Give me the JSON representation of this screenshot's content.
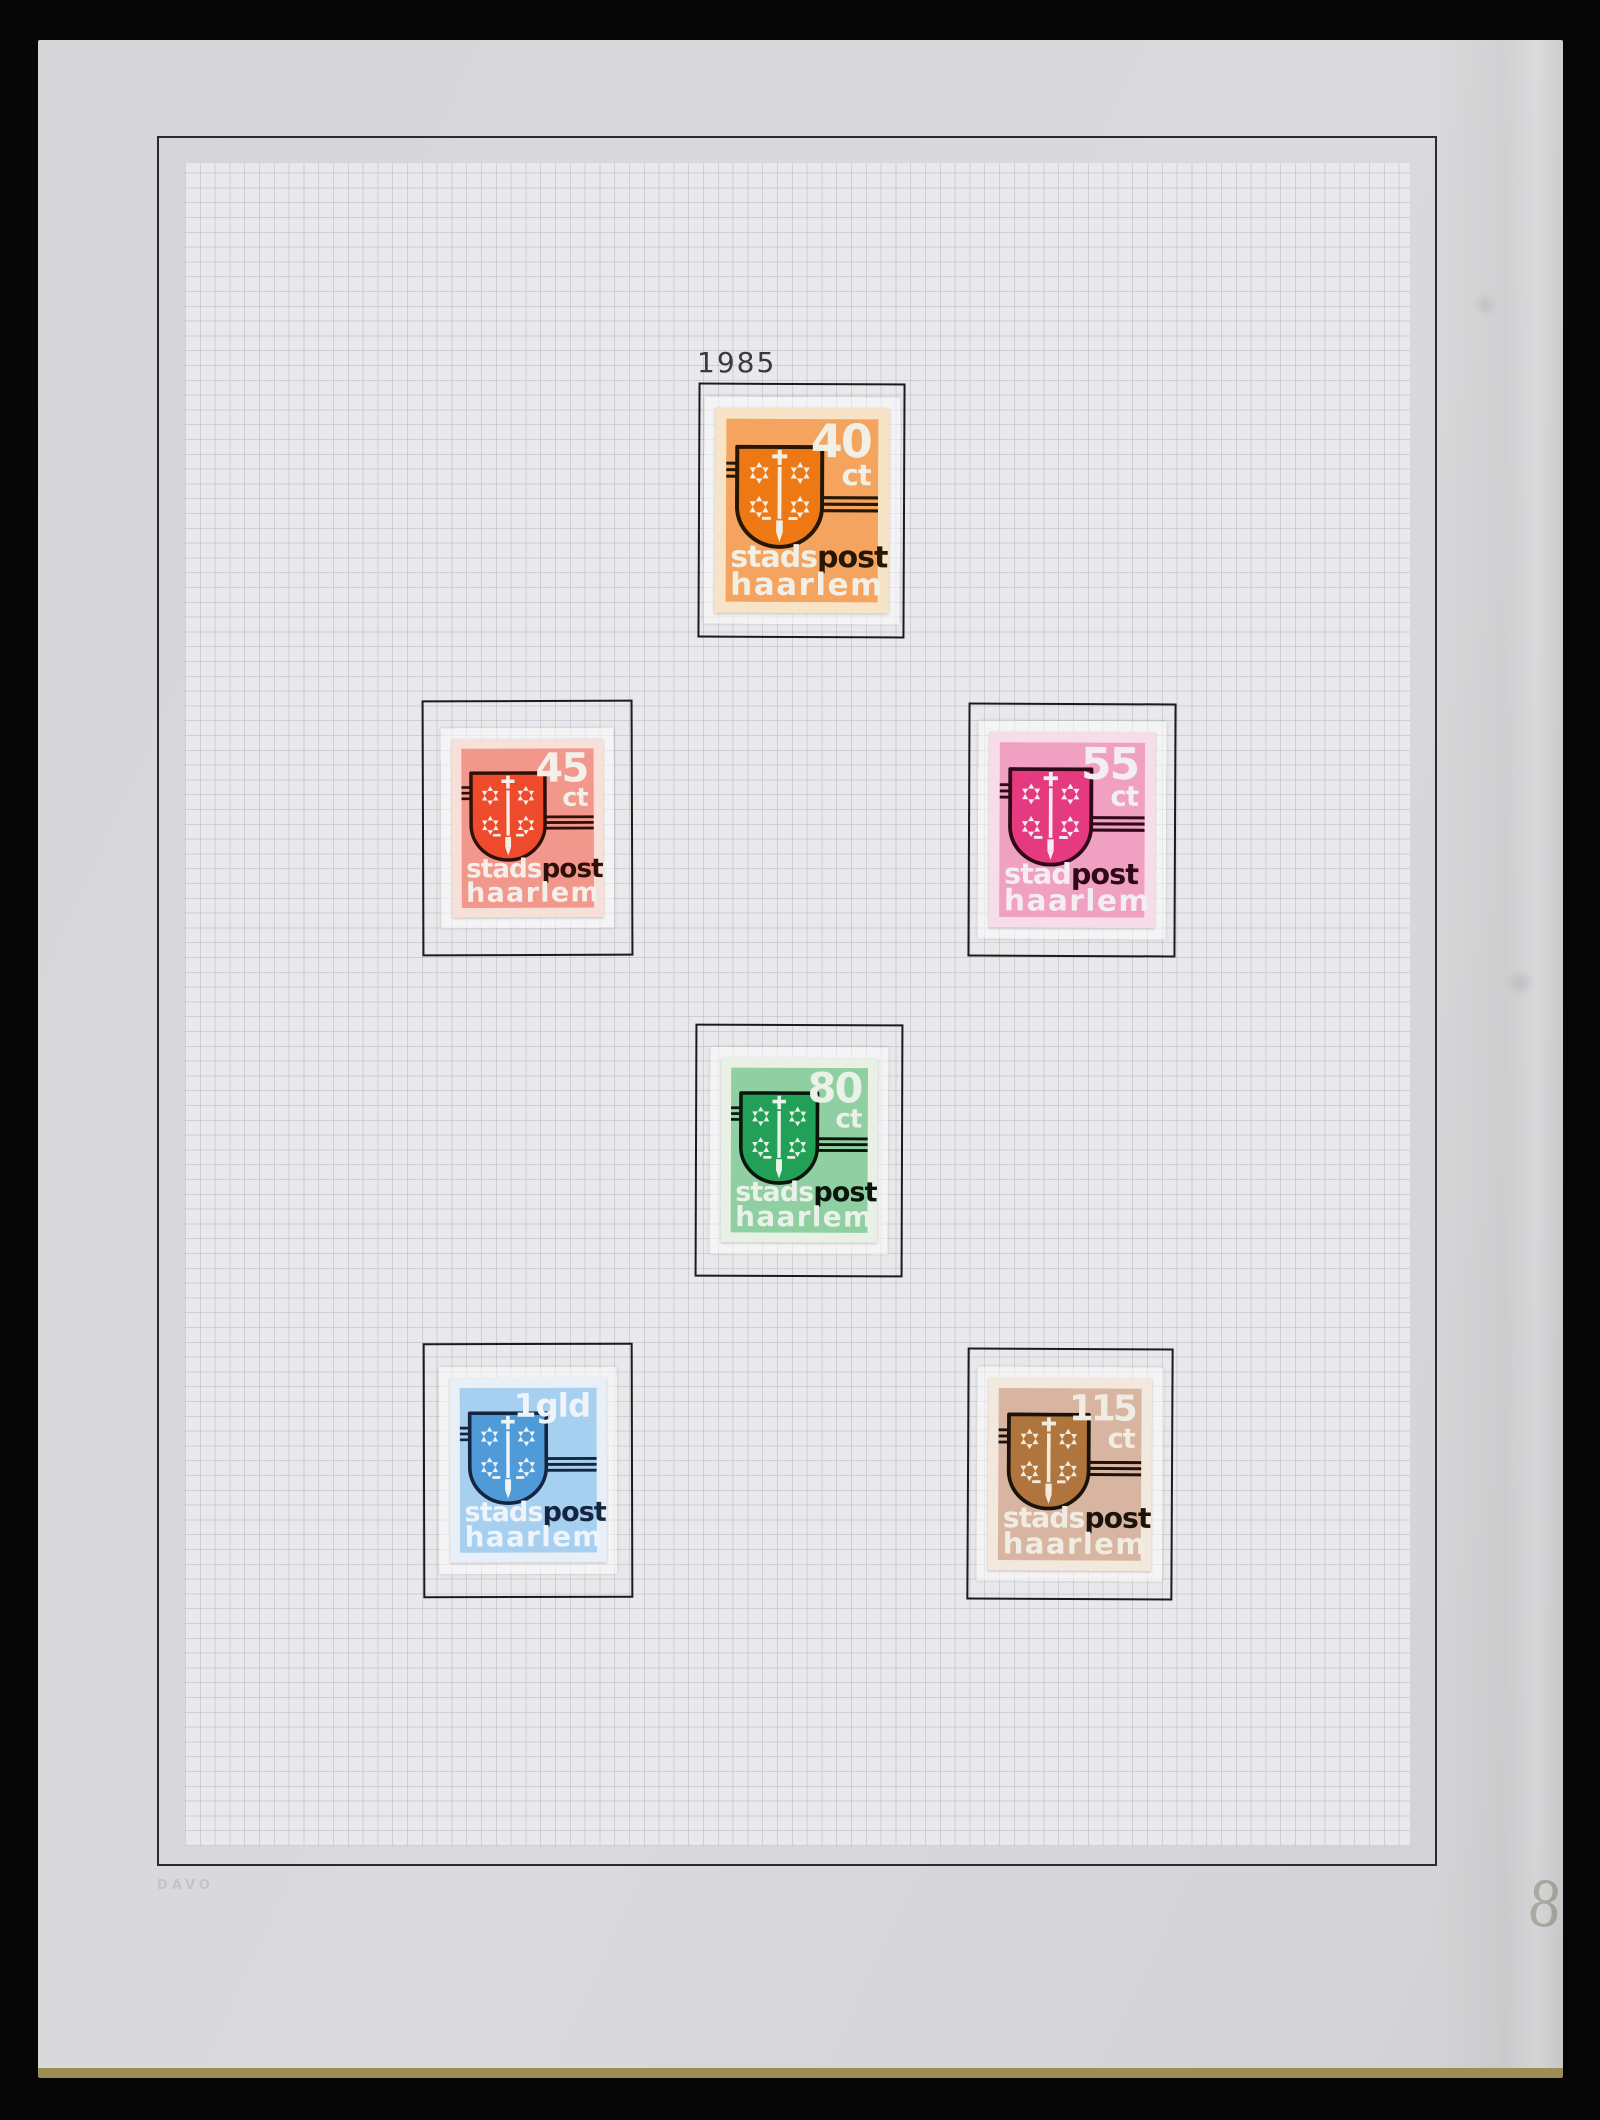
{
  "page": {
    "year_label": "1985",
    "brand_label": "DAVO",
    "handwritten_page_number": "8"
  },
  "stamps": [
    {
      "name": "stadspost haarlem 40 ct",
      "value": "40",
      "unit": "ct",
      "word_white": "stads",
      "word_dark": "post",
      "word_bottom": "haarlem",
      "colors": {
        "paper": "#f7e3c6",
        "bg": "#f4a45e",
        "shield": "#ee7914",
        "dark": "#271604",
        "light": "#f2efe7"
      }
    },
    {
      "name": "stadspost haarlem 45 ct",
      "value": "45",
      "unit": "ct",
      "word_white": "stads",
      "word_dark": "post",
      "word_bottom": "haarlem",
      "colors": {
        "paper": "#f7e0d8",
        "bg": "#f1978c",
        "shield": "#ee4b2c",
        "dark": "#2e1008",
        "light": "#f5efe9"
      }
    },
    {
      "name": "stadpost haarlem 55 ct",
      "value": "55",
      "unit": "ct",
      "word_white": "stad",
      "word_dark": "post",
      "word_bottom": "haarlem",
      "colors": {
        "paper": "#f6dde7",
        "bg": "#f0a0c1",
        "shield": "#e63a80",
        "dark": "#2e0919",
        "light": "#f4eef1"
      }
    },
    {
      "name": "stadspost haarlem 80 ct",
      "value": "80",
      "unit": "ct",
      "word_white": "stads",
      "word_dark": "post",
      "word_bottom": "haarlem",
      "colors": {
        "paper": "#e9f1e6",
        "bg": "#90cfa2",
        "shield": "#23a058",
        "dark": "#0c150c",
        "light": "#eaf1e8"
      }
    },
    {
      "name": "stadspost haarlem 1 gld",
      "value": "1gld",
      "unit": "",
      "word_white": "stads",
      "word_dark": "post",
      "word_bottom": "haarlem",
      "colors": {
        "paper": "#e8eff6",
        "bg": "#a7cfef",
        "shield": "#4f9bd8",
        "dark": "#152540",
        "light": "#eef4f9"
      }
    },
    {
      "name": "stadspost haarlem 115 ct",
      "value": "115",
      "unit": "ct",
      "word_white": "stads",
      "word_dark": "post",
      "word_bottom": "haarlem",
      "colors": {
        "paper": "#f2e8de",
        "bg": "#d8b5a1",
        "shield": "#af753c",
        "dark": "#1b130b",
        "light": "#f1ece1"
      }
    }
  ]
}
